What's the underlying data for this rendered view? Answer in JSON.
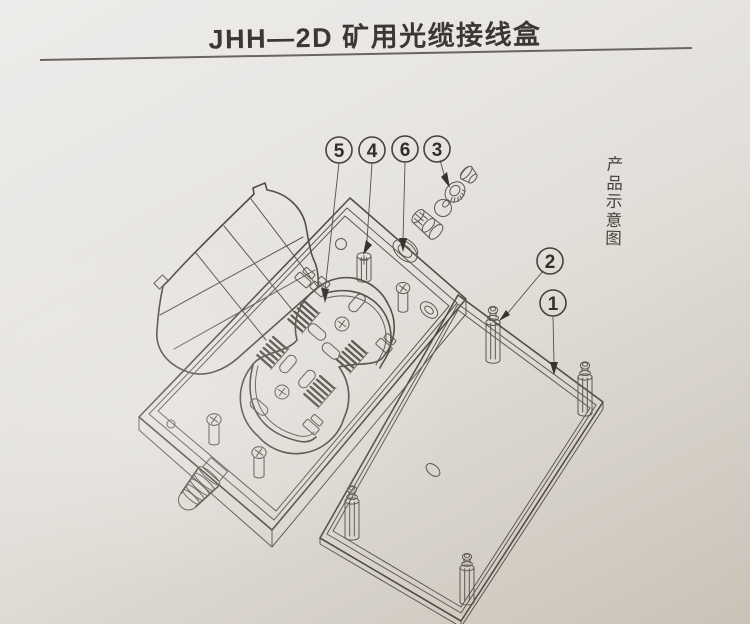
{
  "header": {
    "title": "JHH—2D 矿用光缆接线盒"
  },
  "side_label": {
    "text": "产品示意图"
  },
  "callouts": {
    "items": [
      {
        "label": "5"
      },
      {
        "label": "4"
      },
      {
        "label": "6"
      },
      {
        "label": "3"
      },
      {
        "label": "2"
      },
      {
        "label": "1"
      }
    ]
  },
  "colors": {
    "paper_light": "#edecea",
    "paper_dark": "#c9c2b7",
    "line_ink": "#5d5751",
    "text_ink": "#3b3733"
  }
}
